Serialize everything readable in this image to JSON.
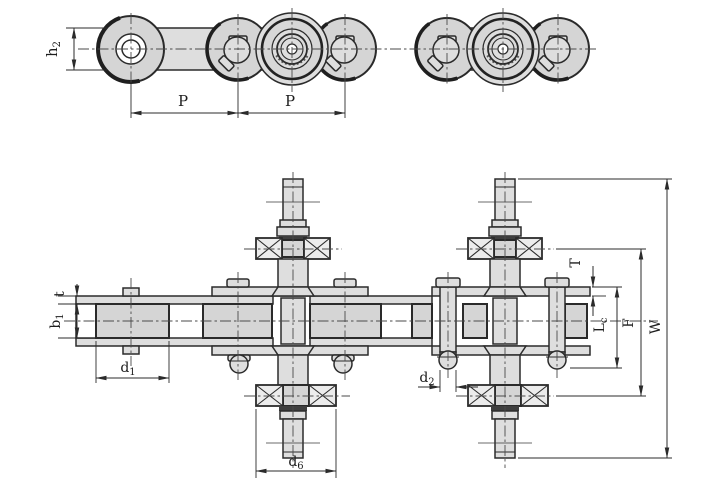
{
  "drawing": {
    "kind": "engineering drawing - conveyor roller chain with extended bearing pins, side elevation and plan section views",
    "colors": {
      "background": "#ffffff",
      "part_fill": "#dedede",
      "roller_fill": "#d5d5d5",
      "bearing_fill": "#ececec",
      "outline": "#2b2b2b",
      "centerline": "#4a4a4a",
      "dark_band": "#3f3f3f"
    },
    "dims": {
      "h2": {
        "base": "h",
        "sub": "2"
      },
      "p1": {
        "label": "P"
      },
      "p2": {
        "label": "P"
      },
      "t": {
        "label": "t"
      },
      "b1": {
        "base": "b",
        "sub": "1"
      },
      "d1": {
        "base": "d",
        "sub": "1"
      },
      "d2": {
        "base": "d",
        "sub": "2"
      },
      "d6": {
        "base": "d",
        "sub": "6"
      },
      "T": {
        "label": "T"
      },
      "Lc": {
        "base": "L",
        "sub": "c"
      },
      "F": {
        "label": "F"
      },
      "W": {
        "label": "W"
      }
    }
  }
}
